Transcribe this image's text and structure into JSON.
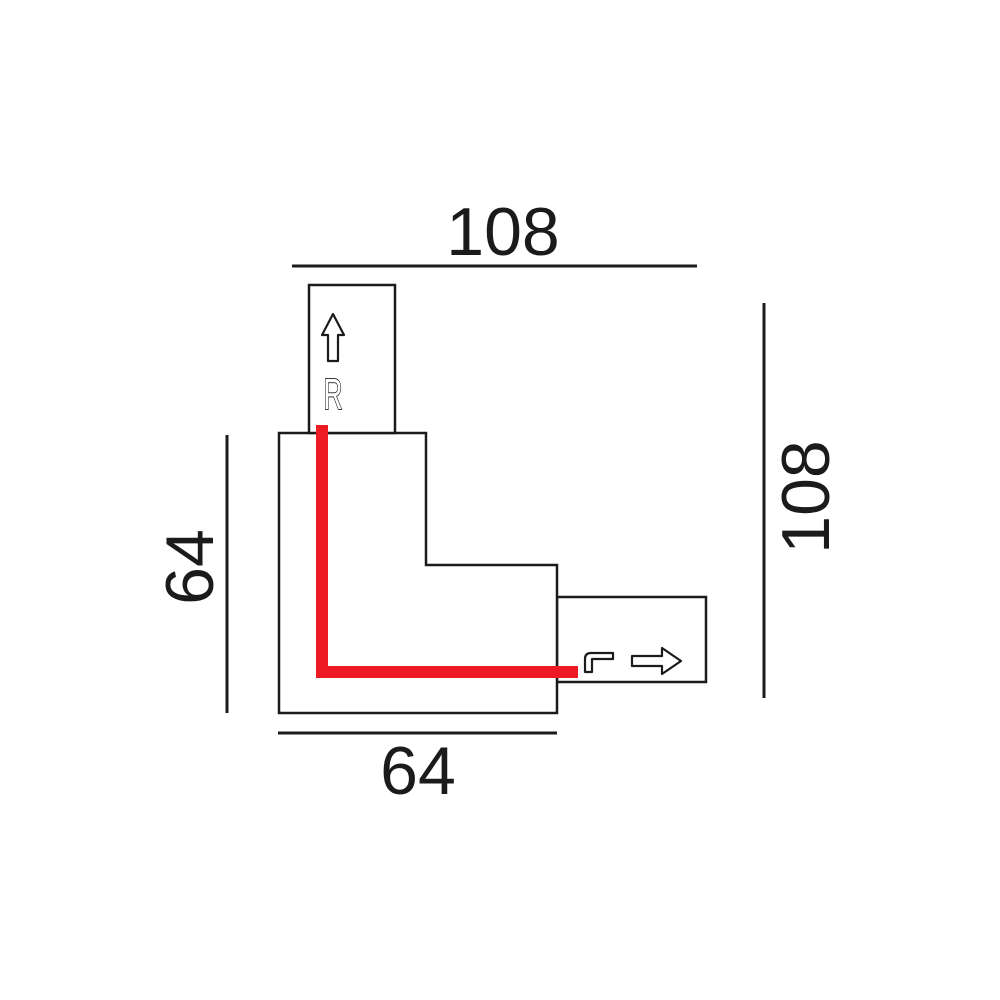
{
  "dimensions": {
    "top": "108",
    "right": "108",
    "left": "64",
    "bottom": "64"
  },
  "connector": {
    "top_stub_label": "R"
  },
  "icons": {
    "up_arrow": "up-arrow-icon",
    "right_arrow": "right-arrow-icon",
    "corner_path": "corner-path-icon"
  },
  "colors": {
    "line": "#1b1b1b",
    "red": "#ec1b23",
    "background": "#ffffff"
  }
}
